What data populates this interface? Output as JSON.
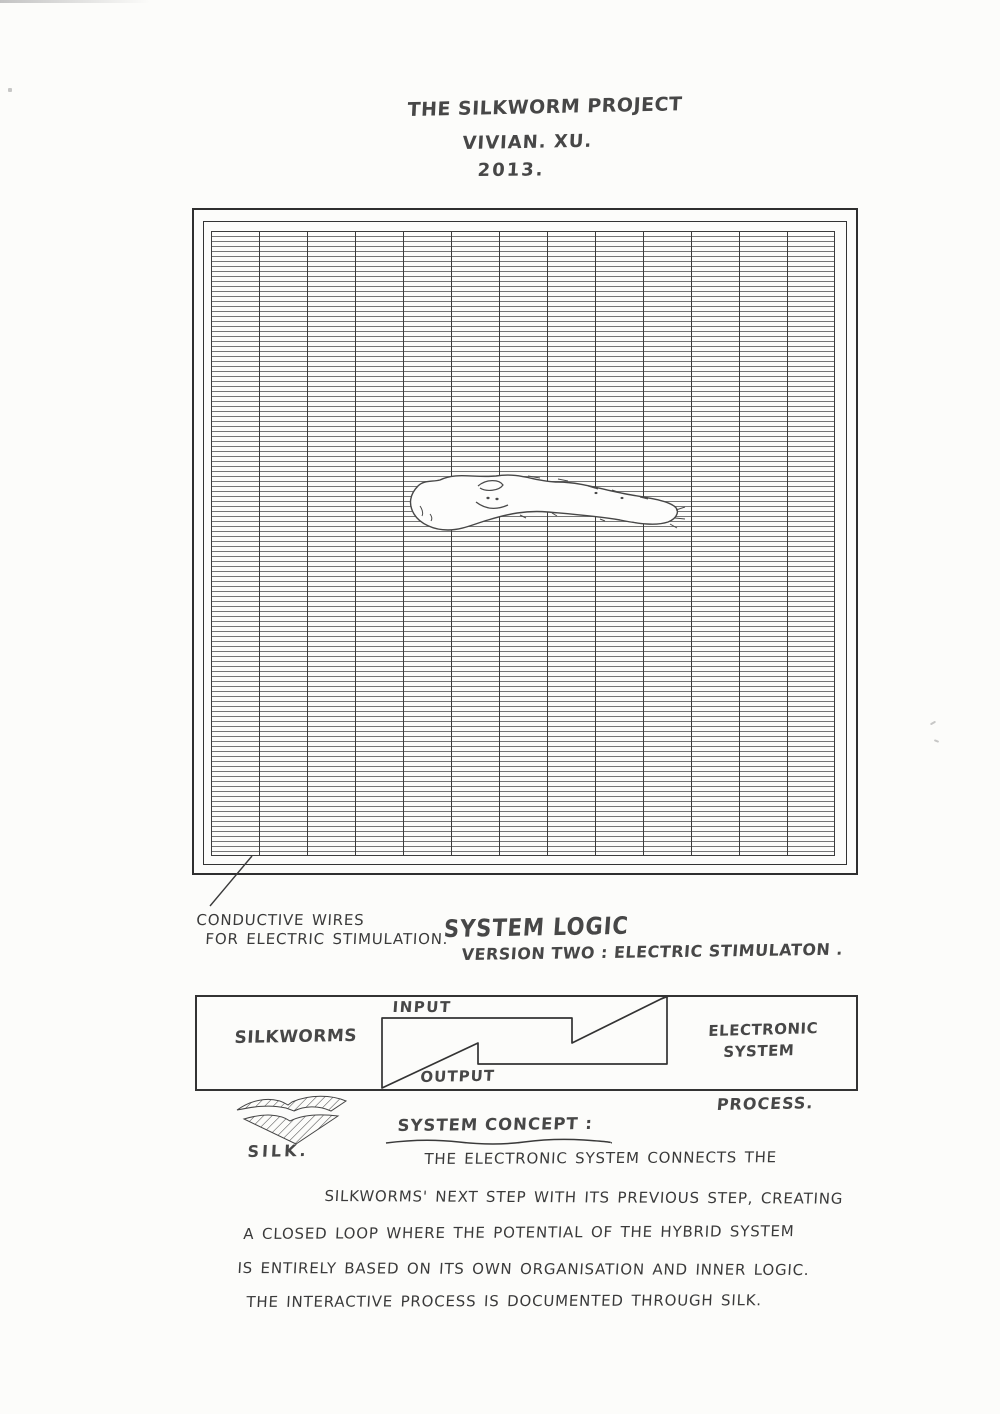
{
  "colors": {
    "paper": "#fcfcfa",
    "ink": "#3a3a3a",
    "marker_ink": "#474747",
    "grid_horizontal_line": "#757575",
    "grid_vertical_line": "#3c3c3c",
    "frame": "#2f2f2f"
  },
  "header": {
    "title": "THE SILKWORM PROJECT",
    "author": "VIVIAN. XU.",
    "year": "2013."
  },
  "grid_panel": {
    "silkworm_icon": "silkworm-outline-drawing",
    "leader_line_icon": "leader-line",
    "caption": {
      "line1": "CONDUCTIVE WIRES",
      "line2": "FOR ELECTRIC STIMULATION."
    }
  },
  "system_logic": {
    "heading": "SYSTEM LOGIC",
    "subheading": "VERSION TWO : ELECTRIC STIMULATON ."
  },
  "flow_diagram": {
    "left_label": "SILKWORMS",
    "input_label": "INPUT",
    "output_label": "OUTPUT",
    "right_label_line1": "ELECTRONIC",
    "right_label_line2": "SYSTEM",
    "process_label": "PROCESS.",
    "silk_label": "SILK.",
    "silk_icon": "hatched-chevron-silk-icon",
    "loop_shape_icon": "interlocked-steps-feedback-loop"
  },
  "concept": {
    "heading": "SYSTEM CONCEPT :",
    "lines": [
      "THE ELECTRONIC SYSTEM CONNECTS THE",
      "SILKWORMS' NEXT STEP WITH ITS PREVIOUS STEP, CREATING",
      "A CLOSED LOOP WHERE THE POTENTIAL OF THE HYBRID SYSTEM",
      "IS ENTIRELY BASED ON ITS OWN ORGANISATION AND INNER LOGIC.",
      "THE INTERACTIVE PROCESS IS DOCUMENTED THROUGH  SILK."
    ]
  }
}
